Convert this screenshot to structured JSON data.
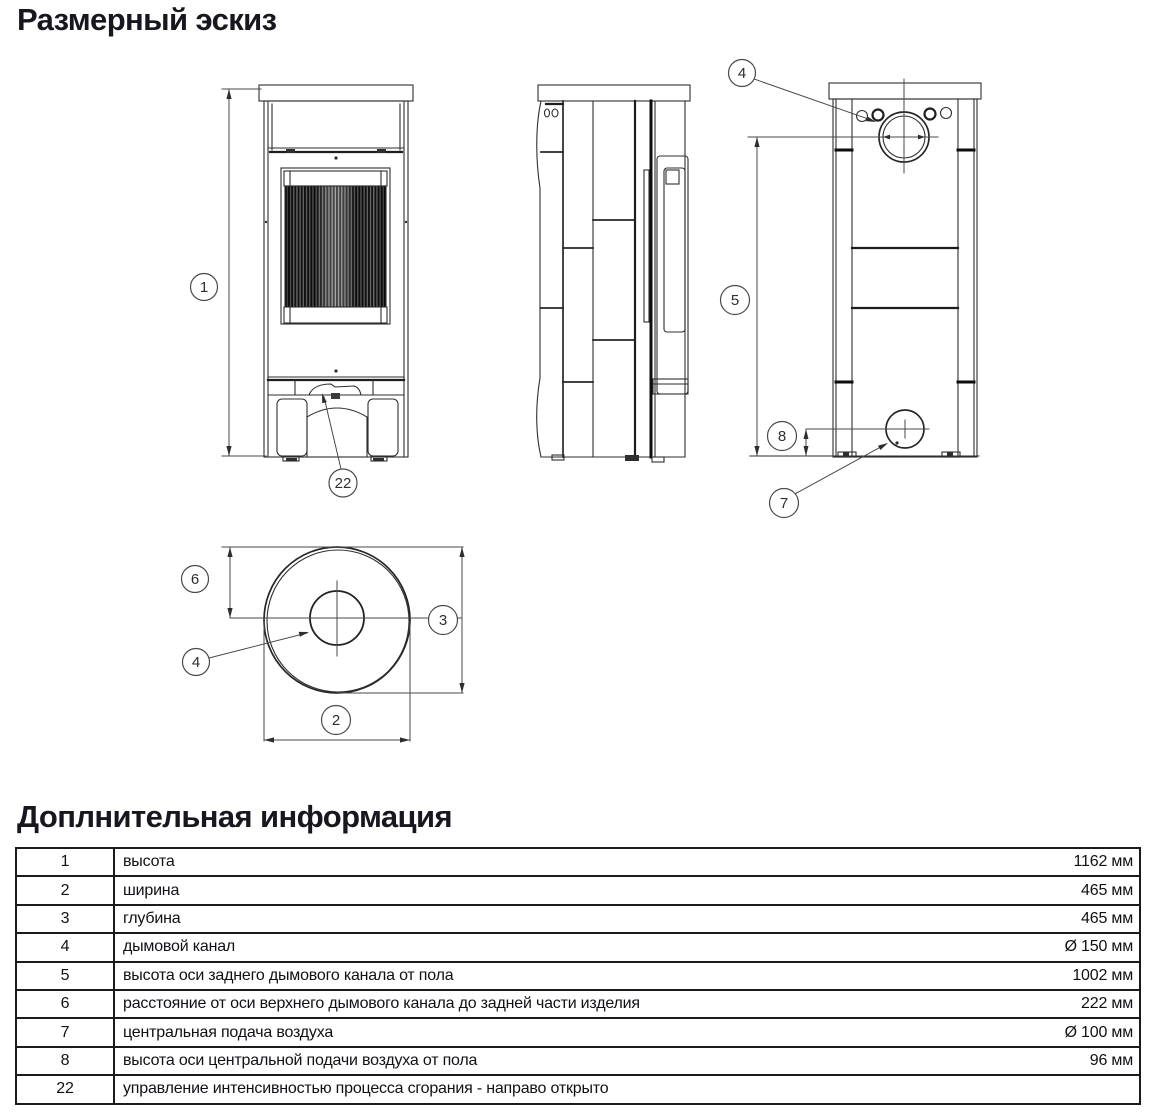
{
  "page": {
    "title": "Размерный эскиз",
    "section2_title": "Доплнительная информация"
  },
  "drawing": {
    "callouts": {
      "height": "1",
      "width": "2",
      "depth": "3",
      "flue": "4",
      "flue_top": "4",
      "flue_height": "5",
      "flue_offset": "6",
      "air": "7",
      "air_height": "8",
      "control": "22"
    }
  },
  "table": {
    "rows": [
      {
        "num": "1",
        "desc": "высота",
        "value": "1162 мм"
      },
      {
        "num": "2",
        "desc": "ширина",
        "value": "465 мм"
      },
      {
        "num": "3",
        "desc": "глубина",
        "value": "465 мм"
      },
      {
        "num": "4",
        "desc": "дымовой канал",
        "value": "Ø 150 мм"
      },
      {
        "num": "5",
        "desc": "высота оси заднего дымового канала от пола",
        "value": "1002 мм"
      },
      {
        "num": "6",
        "desc": "расстояние от оси верхнего дымового канала до задней части изделия",
        "value": "222 мм"
      },
      {
        "num": "7",
        "desc": "центральная подача воздуха",
        "value": "Ø 100 мм"
      },
      {
        "num": "8",
        "desc": "высота оси центральной подачи воздуха от пола",
        "value": "96 мм"
      },
      {
        "num": "22",
        "desc": "управление интенсивностью процесса сгорания - направо открыто",
        "value": ""
      }
    ]
  }
}
